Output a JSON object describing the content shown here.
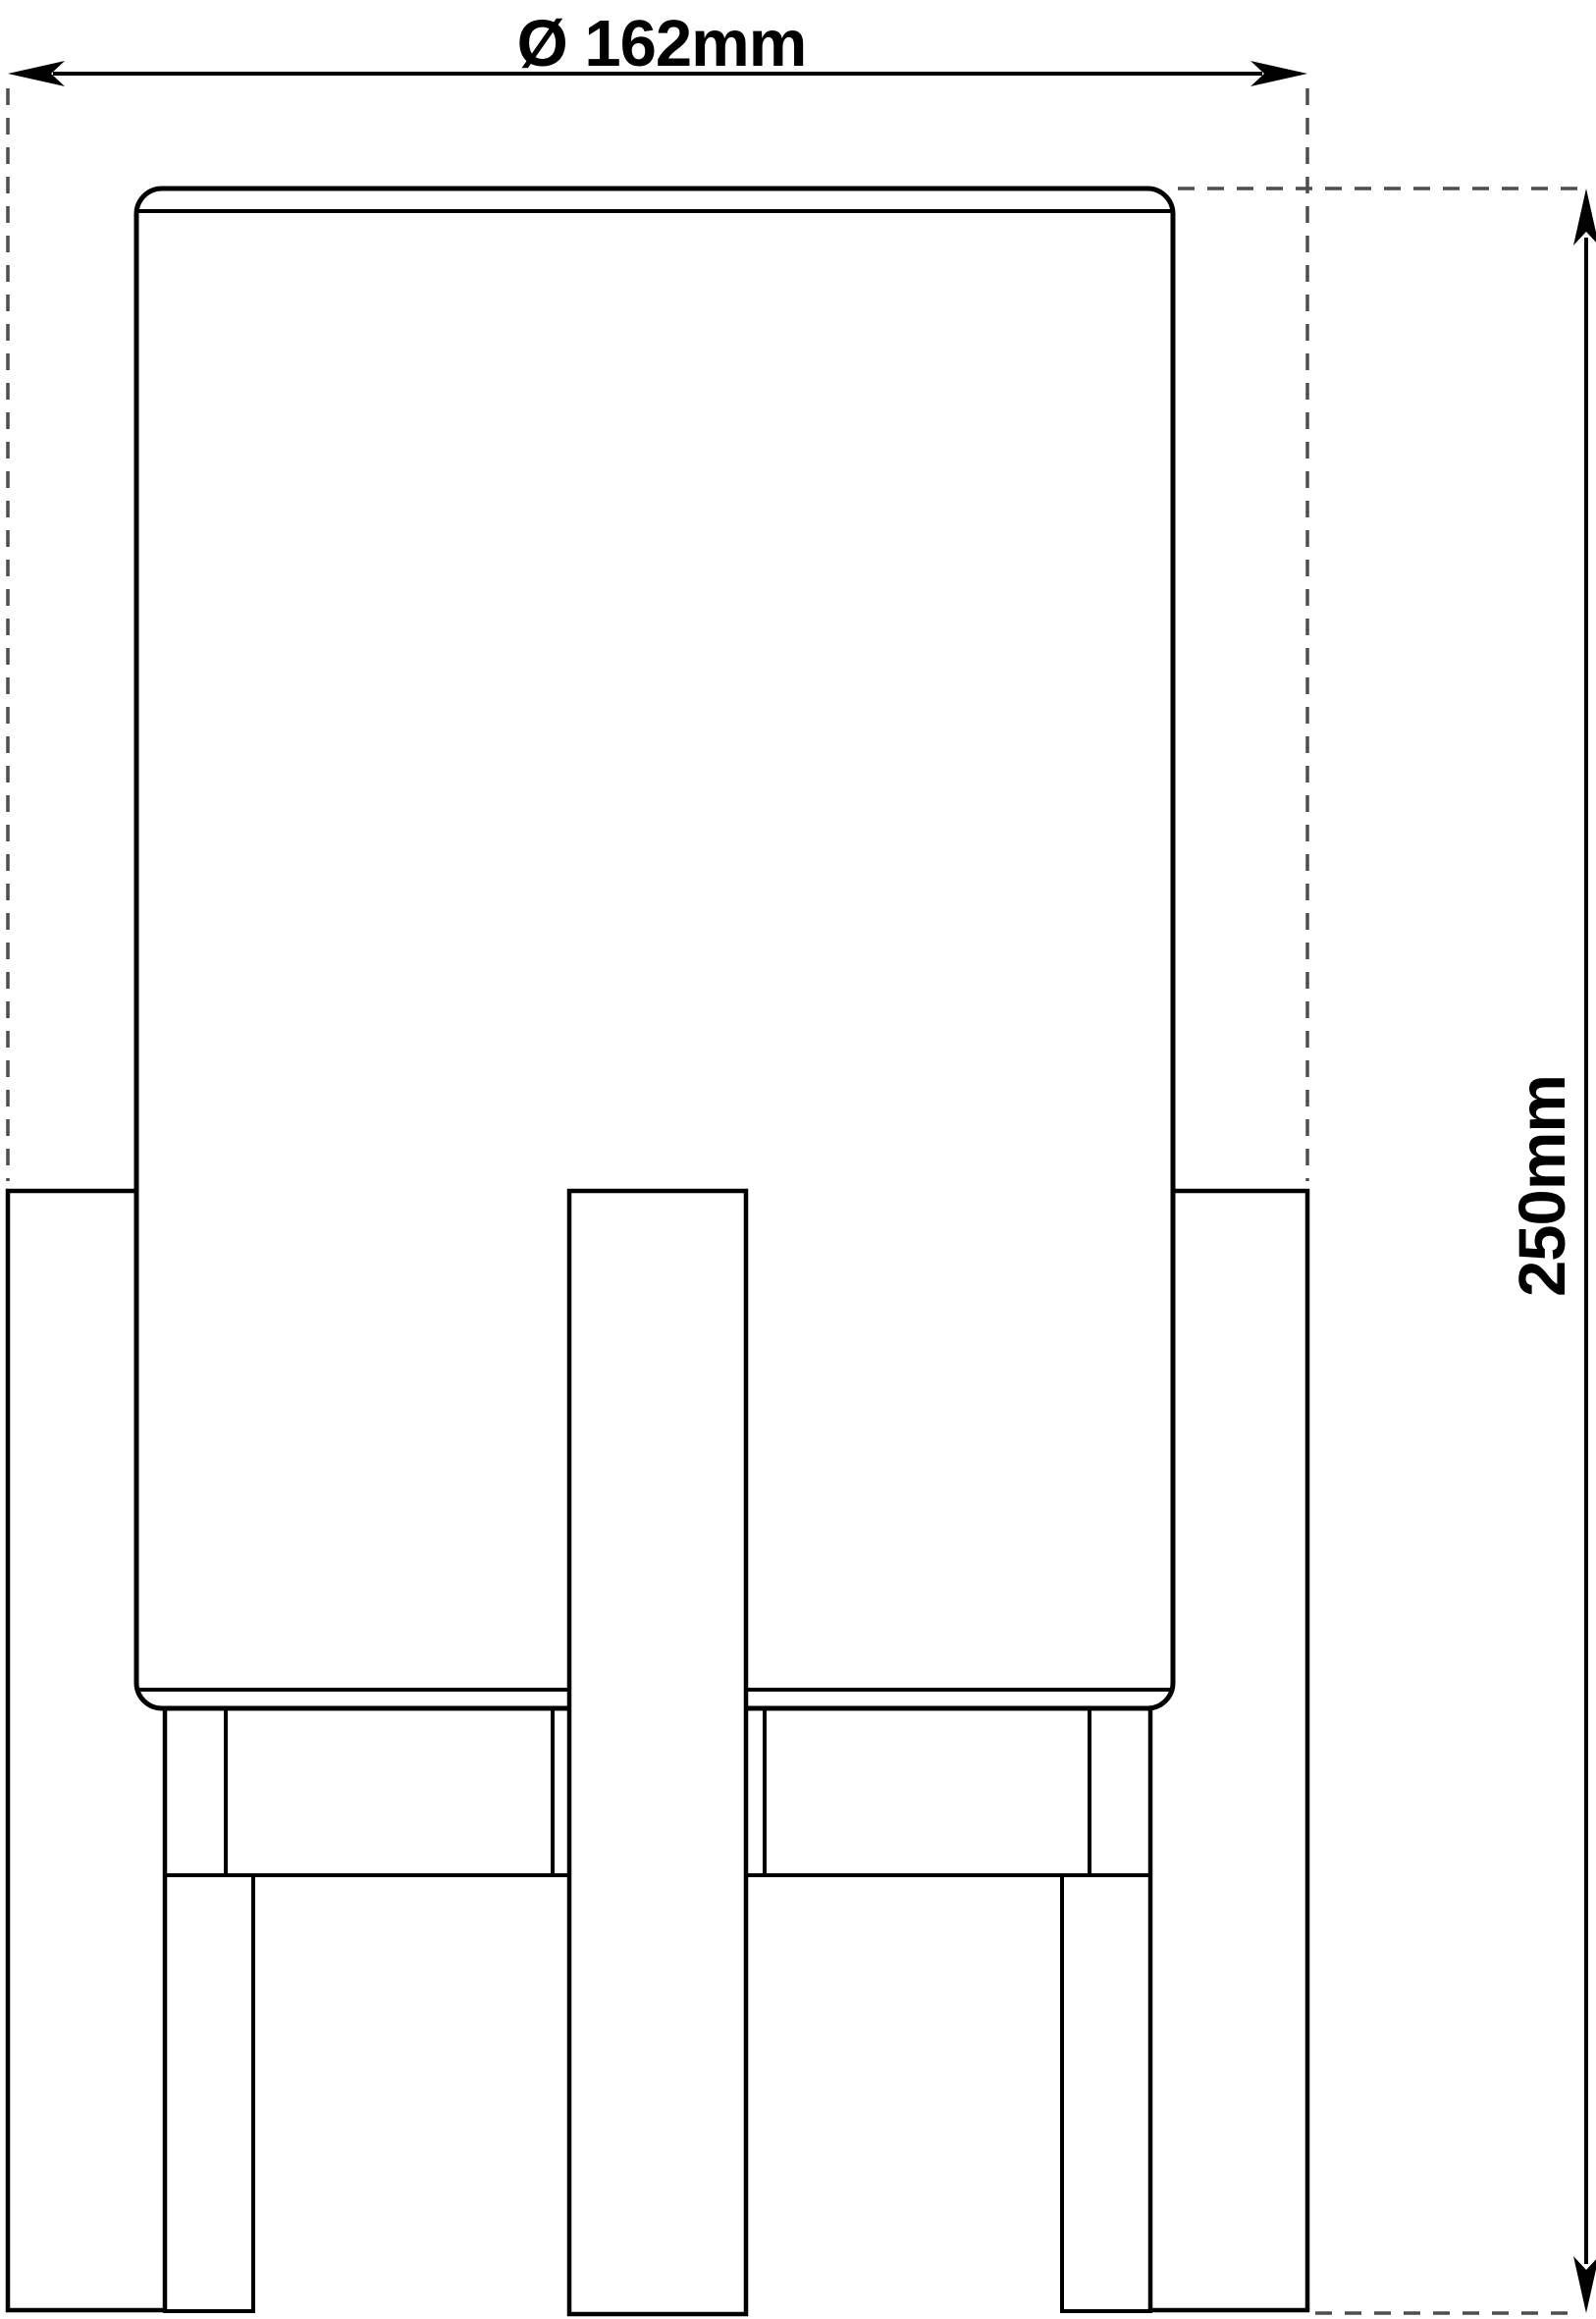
{
  "drawing": {
    "width_label": "Ø 162mm",
    "height_label": "250mm",
    "line_color": "#000000",
    "extension_line_color": "#4d4d4d",
    "background_color": "#ffffff"
  }
}
